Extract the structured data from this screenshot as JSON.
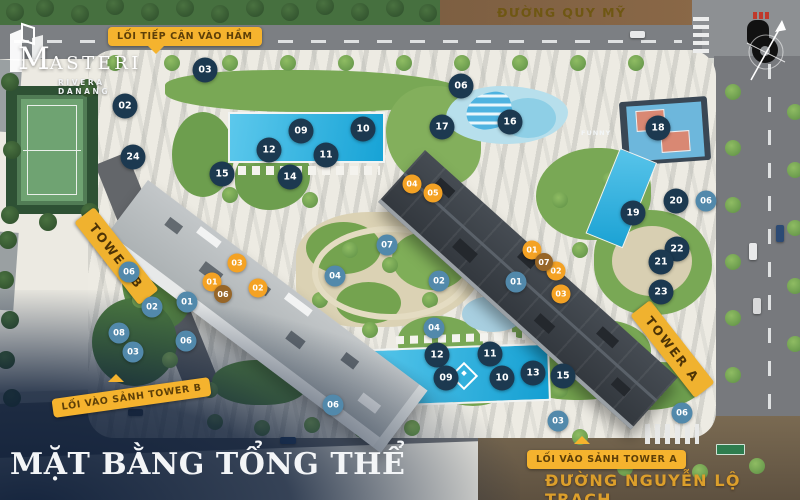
{
  "brand": {
    "name_initial": "M",
    "name_rest": "ASTERI",
    "subtitle": "RIVERA DANANG"
  },
  "title": "MẶT BẰNG TỔNG THỂ",
  "streets": {
    "top": "ĐƯỜNG QUY MỸ",
    "right": "ĐƯỜNG NGUYỄN LỘ TRẠCH"
  },
  "callouts": {
    "basement": "LỐI TIẾP CẬN VÀO HẦM",
    "lobby_b": "LỐI VÀO SẢNH TOWER B",
    "lobby_a": "LỐI VÀO SẢNH TOWER A"
  },
  "towers": {
    "a": "TOWER A",
    "b": "TOWER B"
  },
  "area_texts": {
    "funny": "FUNNY"
  },
  "colors": {
    "marker_dark": "#1c3950",
    "marker_blue": "#5289ab",
    "marker_orange": "#f4a224",
    "marker_bronze": "#976628",
    "badge_yellow": "#f5b32e",
    "street_gold": "#dc9f2b",
    "street_top_gold": "#6f5713",
    "overlay_navy": "#0e1e38",
    "pool_blue": "#1ba2d4"
  },
  "markers": [
    {
      "n": "03",
      "t": "d",
      "x": 205,
      "y": 70
    },
    {
      "n": "02",
      "t": "d",
      "x": 125,
      "y": 106
    },
    {
      "n": "24",
      "t": "d",
      "x": 133,
      "y": 157
    },
    {
      "n": "15",
      "t": "d",
      "x": 222,
      "y": 174
    },
    {
      "n": "12",
      "t": "d",
      "x": 269,
      "y": 150
    },
    {
      "n": "09",
      "t": "d",
      "x": 301,
      "y": 131
    },
    {
      "n": "10",
      "t": "d",
      "x": 363,
      "y": 129
    },
    {
      "n": "11",
      "t": "d",
      "x": 326,
      "y": 155
    },
    {
      "n": "14",
      "t": "d",
      "x": 290,
      "y": 177
    },
    {
      "n": "06",
      "t": "d",
      "x": 461,
      "y": 86
    },
    {
      "n": "17",
      "t": "d",
      "x": 442,
      "y": 127
    },
    {
      "n": "16",
      "t": "d",
      "x": 510,
      "y": 122
    },
    {
      "n": "18",
      "t": "d",
      "x": 658,
      "y": 128
    },
    {
      "n": "19",
      "t": "d",
      "x": 633,
      "y": 213
    },
    {
      "n": "20",
      "t": "d",
      "x": 676,
      "y": 201
    },
    {
      "n": "22",
      "t": "d",
      "x": 677,
      "y": 249
    },
    {
      "n": "21",
      "t": "d",
      "x": 661,
      "y": 262
    },
    {
      "n": "23",
      "t": "d",
      "x": 661,
      "y": 292
    },
    {
      "n": "12",
      "t": "d",
      "x": 437,
      "y": 355
    },
    {
      "n": "11",
      "t": "d",
      "x": 490,
      "y": 354
    },
    {
      "n": "09",
      "t": "d",
      "x": 446,
      "y": 378
    },
    {
      "n": "10",
      "t": "d",
      "x": 502,
      "y": 378
    },
    {
      "n": "13",
      "t": "d",
      "x": 533,
      "y": 373
    },
    {
      "n": "15",
      "t": "d",
      "x": 563,
      "y": 376
    },
    {
      "n": "06",
      "t": "b",
      "x": 706,
      "y": 201
    },
    {
      "n": "07",
      "t": "b",
      "x": 387,
      "y": 245
    },
    {
      "n": "04",
      "t": "b",
      "x": 335,
      "y": 276
    },
    {
      "n": "02",
      "t": "b",
      "x": 439,
      "y": 281
    },
    {
      "n": "04",
      "t": "b",
      "x": 434,
      "y": 328
    },
    {
      "n": "01",
      "t": "b",
      "x": 516,
      "y": 282
    },
    {
      "n": "06",
      "t": "b",
      "x": 129,
      "y": 272
    },
    {
      "n": "02",
      "t": "b",
      "x": 152,
      "y": 307
    },
    {
      "n": "01",
      "t": "b",
      "x": 187,
      "y": 302
    },
    {
      "n": "08",
      "t": "b",
      "x": 119,
      "y": 333
    },
    {
      "n": "03",
      "t": "b",
      "x": 133,
      "y": 352
    },
    {
      "n": "06",
      "t": "b",
      "x": 186,
      "y": 341
    },
    {
      "n": "06",
      "t": "b",
      "x": 333,
      "y": 405
    },
    {
      "n": "03",
      "t": "b",
      "x": 558,
      "y": 421
    },
    {
      "n": "06",
      "t": "b",
      "x": 682,
      "y": 413
    },
    {
      "n": "04",
      "t": "o",
      "x": 412,
      "y": 184
    },
    {
      "n": "05",
      "t": "o",
      "x": 433,
      "y": 193
    },
    {
      "n": "01",
      "t": "o",
      "x": 532,
      "y": 250
    },
    {
      "n": "02",
      "t": "o",
      "x": 556,
      "y": 271
    },
    {
      "n": "03",
      "t": "o",
      "x": 561,
      "y": 294
    },
    {
      "n": "03",
      "t": "o",
      "x": 237,
      "y": 263
    },
    {
      "n": "01",
      "t": "o",
      "x": 212,
      "y": 282
    },
    {
      "n": "02",
      "t": "o",
      "x": 258,
      "y": 288
    },
    {
      "n": "06",
      "t": "z",
      "x": 223,
      "y": 294
    },
    {
      "n": "07",
      "t": "z",
      "x": 544,
      "y": 262
    }
  ]
}
